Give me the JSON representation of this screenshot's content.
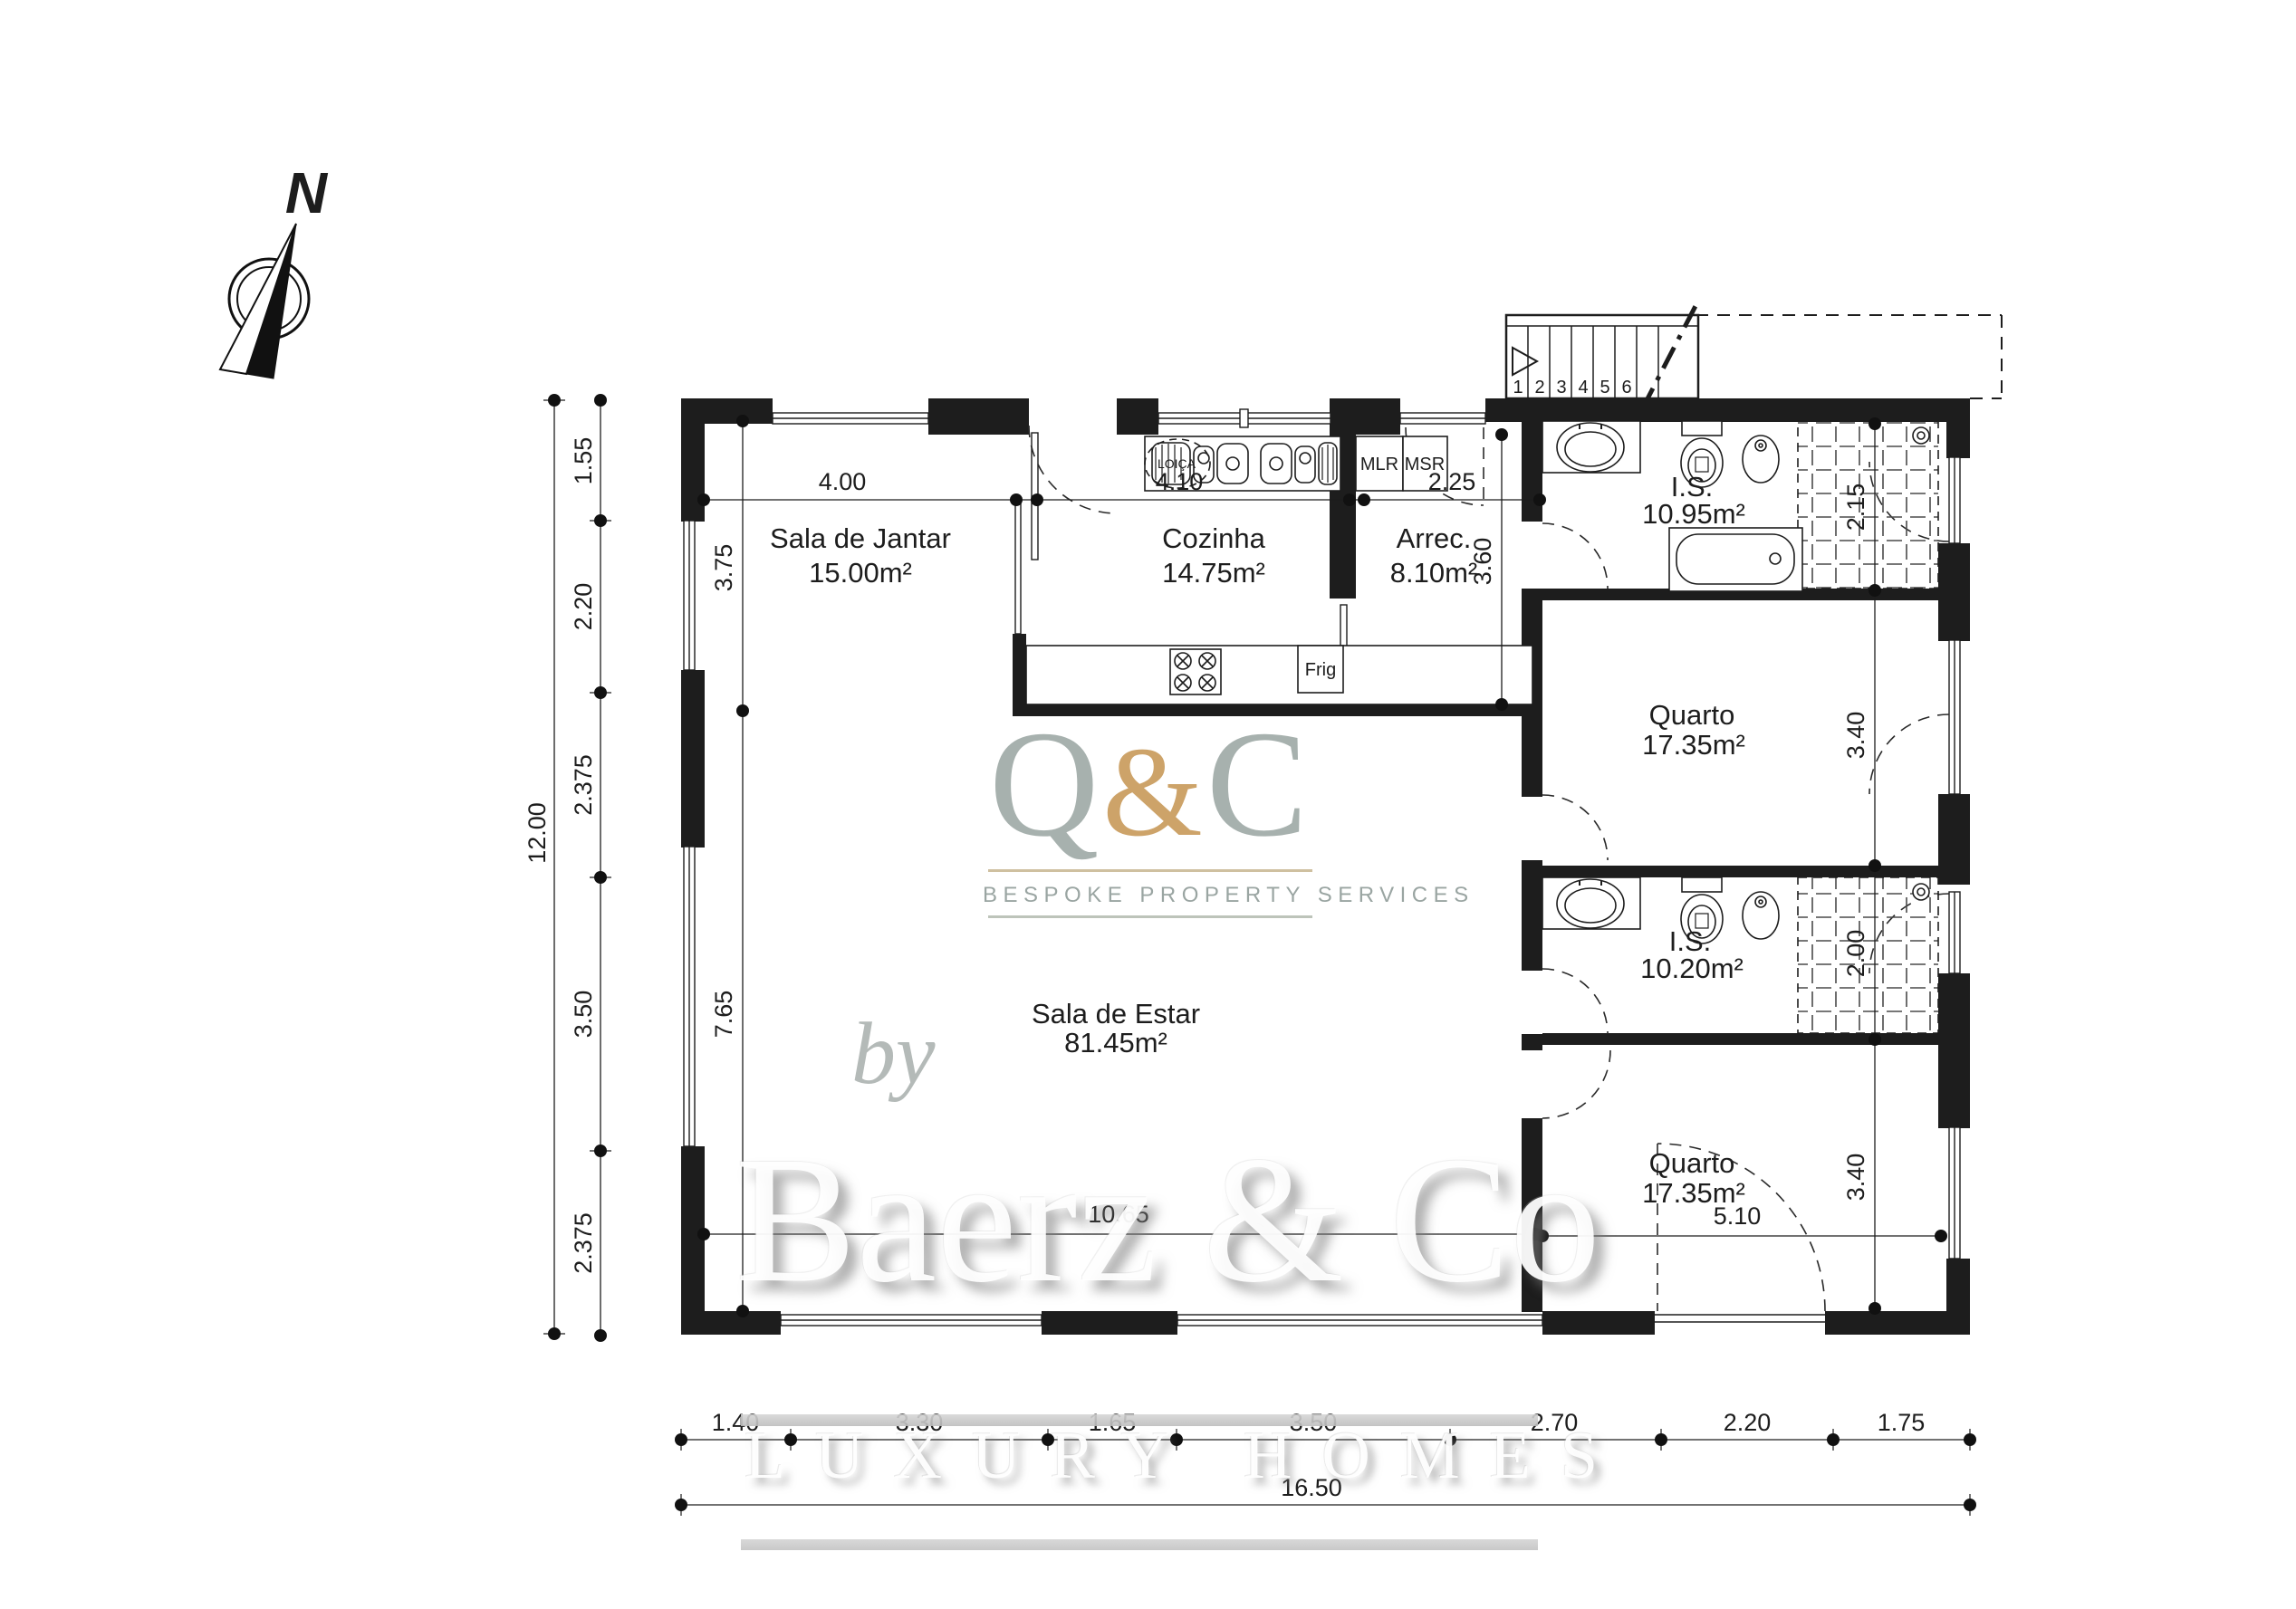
{
  "plan": {
    "compass_label": "N",
    "rooms": {
      "jantar": {
        "name": "Sala de Jantar",
        "area": "15.00m²"
      },
      "cozinha": {
        "name": "Cozinha",
        "area": "14.75m²"
      },
      "arrec": {
        "name": "Arrec.",
        "area": "8.10m²"
      },
      "is1": {
        "name": "I.S.",
        "area": "10.95m²"
      },
      "quarto1": {
        "name": "Quarto",
        "area": "17.35m²"
      },
      "is2": {
        "name": "I.S.",
        "area": "10.20m²"
      },
      "quarto2": {
        "name": "Quarto",
        "area": "17.35m²"
      },
      "estar": {
        "name": "Sala de Estar",
        "area": "81.45m²"
      }
    },
    "appliances": {
      "dishwasher": "LOIÇA",
      "washer": "MLR",
      "dryer": "MSR",
      "fridge": "Frig"
    },
    "stairs": {
      "treads": [
        "1",
        "2",
        "3",
        "4",
        "5",
        "6"
      ]
    },
    "dimensions": {
      "left_total": "12.00",
      "left_chain": [
        "1.55",
        "2.20",
        "2.375",
        "3.50",
        "2.375"
      ],
      "jantar_height": "3.75",
      "estar_height": "7.65",
      "top_chain": [
        "4.00",
        "4.10",
        "2.25"
      ],
      "arrec_height": "3.60",
      "right_chain": [
        "2.15",
        "3.40",
        "2.00",
        "3.40"
      ],
      "quarto2_width": "5.10",
      "estar_width": "10.65",
      "bottom_chain": [
        "1.40",
        "3.30",
        "1.65",
        "3.50",
        "2.70",
        "2.20",
        "1.75"
      ],
      "bottom_total": "16.50"
    }
  },
  "watermark": {
    "logo": {
      "q": "Q",
      "amp": "&",
      "c": "C",
      "tagline": "BESPOKE PROPERTY SERVICES"
    },
    "by": "by",
    "brand": "Baerz & Co",
    "footer": "LUXURY HOMES"
  },
  "colors": {
    "line": "#1d1d1d",
    "logo_gray": "#a7b1ae",
    "logo_gold": "#cda369",
    "watermark_gray": "#c9c9c9"
  }
}
